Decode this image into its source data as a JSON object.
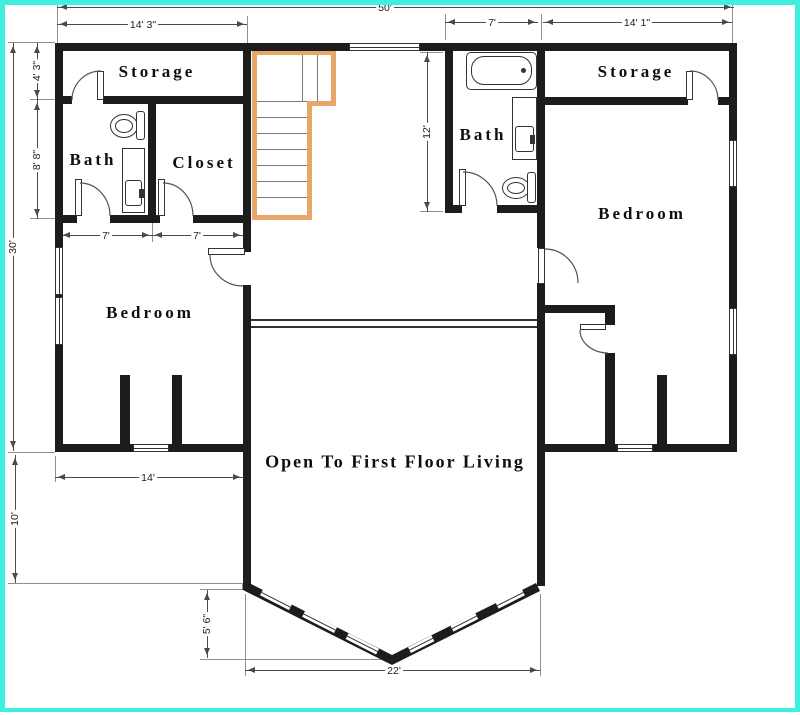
{
  "title": "Second Floor Plan",
  "colors": {
    "page_border": "#3ff0e2",
    "wall": "#1c1c1c",
    "stairs": "#e7a76a"
  },
  "rooms": {
    "storage_left": "Storage",
    "bath_left": "Bath",
    "closet_left": "Closet",
    "bedroom_left": "Bedroom",
    "bath_right": "Bath",
    "storage_right": "Storage",
    "bedroom_right": "Bedroom",
    "open_living": "Open To First Floor Living"
  },
  "dims": {
    "overall_width": "50'",
    "top_left_wing": "14' 3\"",
    "top_bath": "7'",
    "top_right_wing": "14' 1\"",
    "left_storage_depth": "4' 3\"",
    "left_bath_depth": "8' 8\"",
    "left_overall": "30'",
    "left_lower": "10'",
    "bath_width": "7'",
    "closet_width": "7'",
    "right_bath_depth": "12'",
    "bedroom_width": "14'",
    "bay_depth": "5' 6\"",
    "bay_width": "22'"
  }
}
